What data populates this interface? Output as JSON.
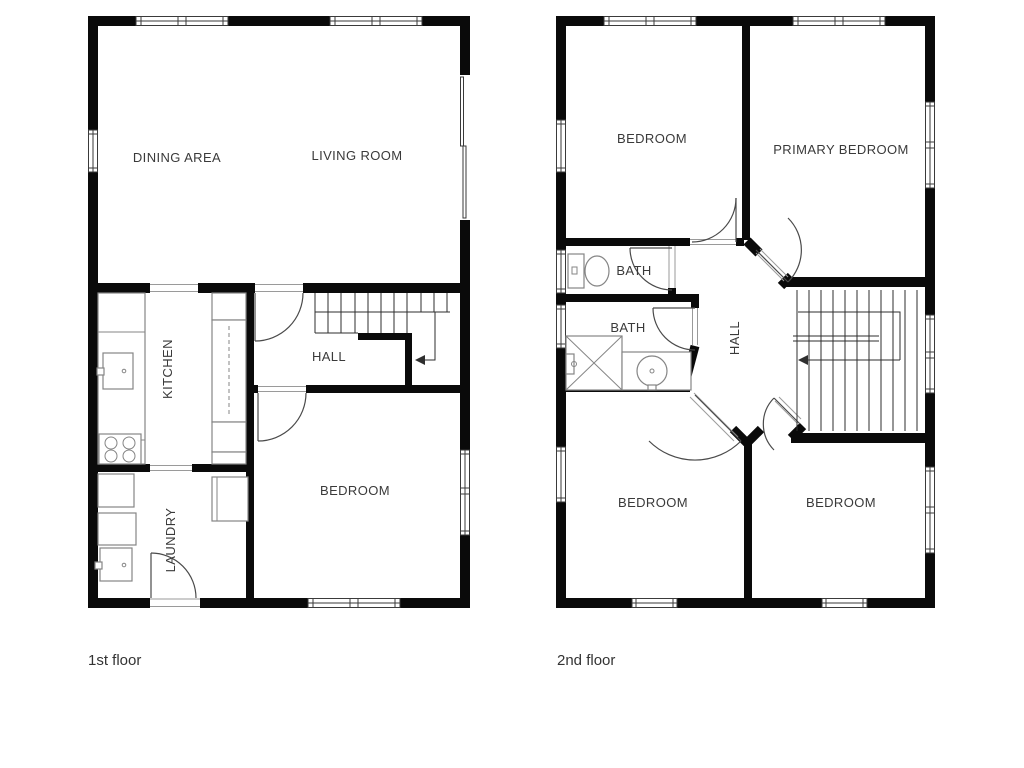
{
  "colors": {
    "wall": "#0a0a0a",
    "text": "#3a3a3a",
    "fixture_stroke": "#858585",
    "door_stroke": "#4a4a4a",
    "background": "#ffffff"
  },
  "floors": {
    "first": {
      "caption": "1st floor",
      "rooms": {
        "dining": "DINING AREA",
        "living": "LIVING ROOM",
        "kitchen": "KITCHEN",
        "hall": "HALL",
        "bedroom": "BEDROOM",
        "laundry": "LAUNDRY"
      }
    },
    "second": {
      "caption": "2nd floor",
      "rooms": {
        "bedroom_left": "BEDROOM",
        "primary": "PRIMARY BEDROOM",
        "bath_upper": "BATH",
        "bath_lower": "BATH",
        "hall": "HALL",
        "bedroom_bottom_left": "BEDROOM",
        "bedroom_bottom_right": "BEDROOM"
      }
    }
  }
}
